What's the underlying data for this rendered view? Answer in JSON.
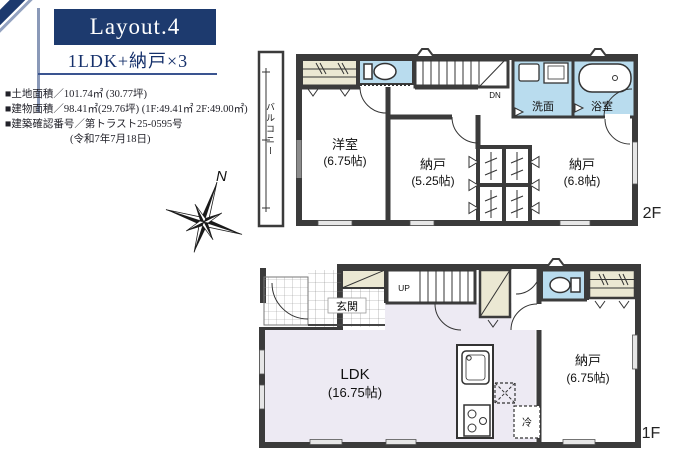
{
  "header": {
    "layout_title": "Layout.4",
    "plan_type": "1LDK+納戸×3"
  },
  "details": {
    "land_area": "■土地面積／101.74㎡ (30.77坪)",
    "building_area": "■建物面積／98.41㎡(29.76坪) (1F:49.41㎡ 2F:49.00㎡)",
    "confirmation_number": "■建築確認番号／第トラスト25-0595号",
    "confirmation_date": "(令和7年7月18日)"
  },
  "compass": {
    "north_label": "N"
  },
  "floor2": {
    "label": "2F",
    "balcony": "バルコニー",
    "stairs": "DN",
    "washroom": "洗面",
    "bathroom": "浴室",
    "western_room_name": "洋室",
    "western_room_size": "(6.75帖)",
    "storage1_name": "納戸",
    "storage1_size": "(5.25帖)",
    "storage2_name": "納戸",
    "storage2_size": "(6.8帖)"
  },
  "floor1": {
    "label": "1F",
    "entrance": "玄関",
    "stairs": "UP",
    "ldk_name": "LDK",
    "ldk_size": "(16.75帖)",
    "storage_name": "納戸",
    "storage_size": "(6.75帖)",
    "refrigerator": "冷"
  },
  "colors": {
    "accent_navy": "#1d3a6e",
    "wall_gray": "#3b3b3b",
    "water_room_blue": "#b9dcee",
    "closet_cream": "#ebe8d3",
    "ldk_lavender": "#edeaf3"
  }
}
